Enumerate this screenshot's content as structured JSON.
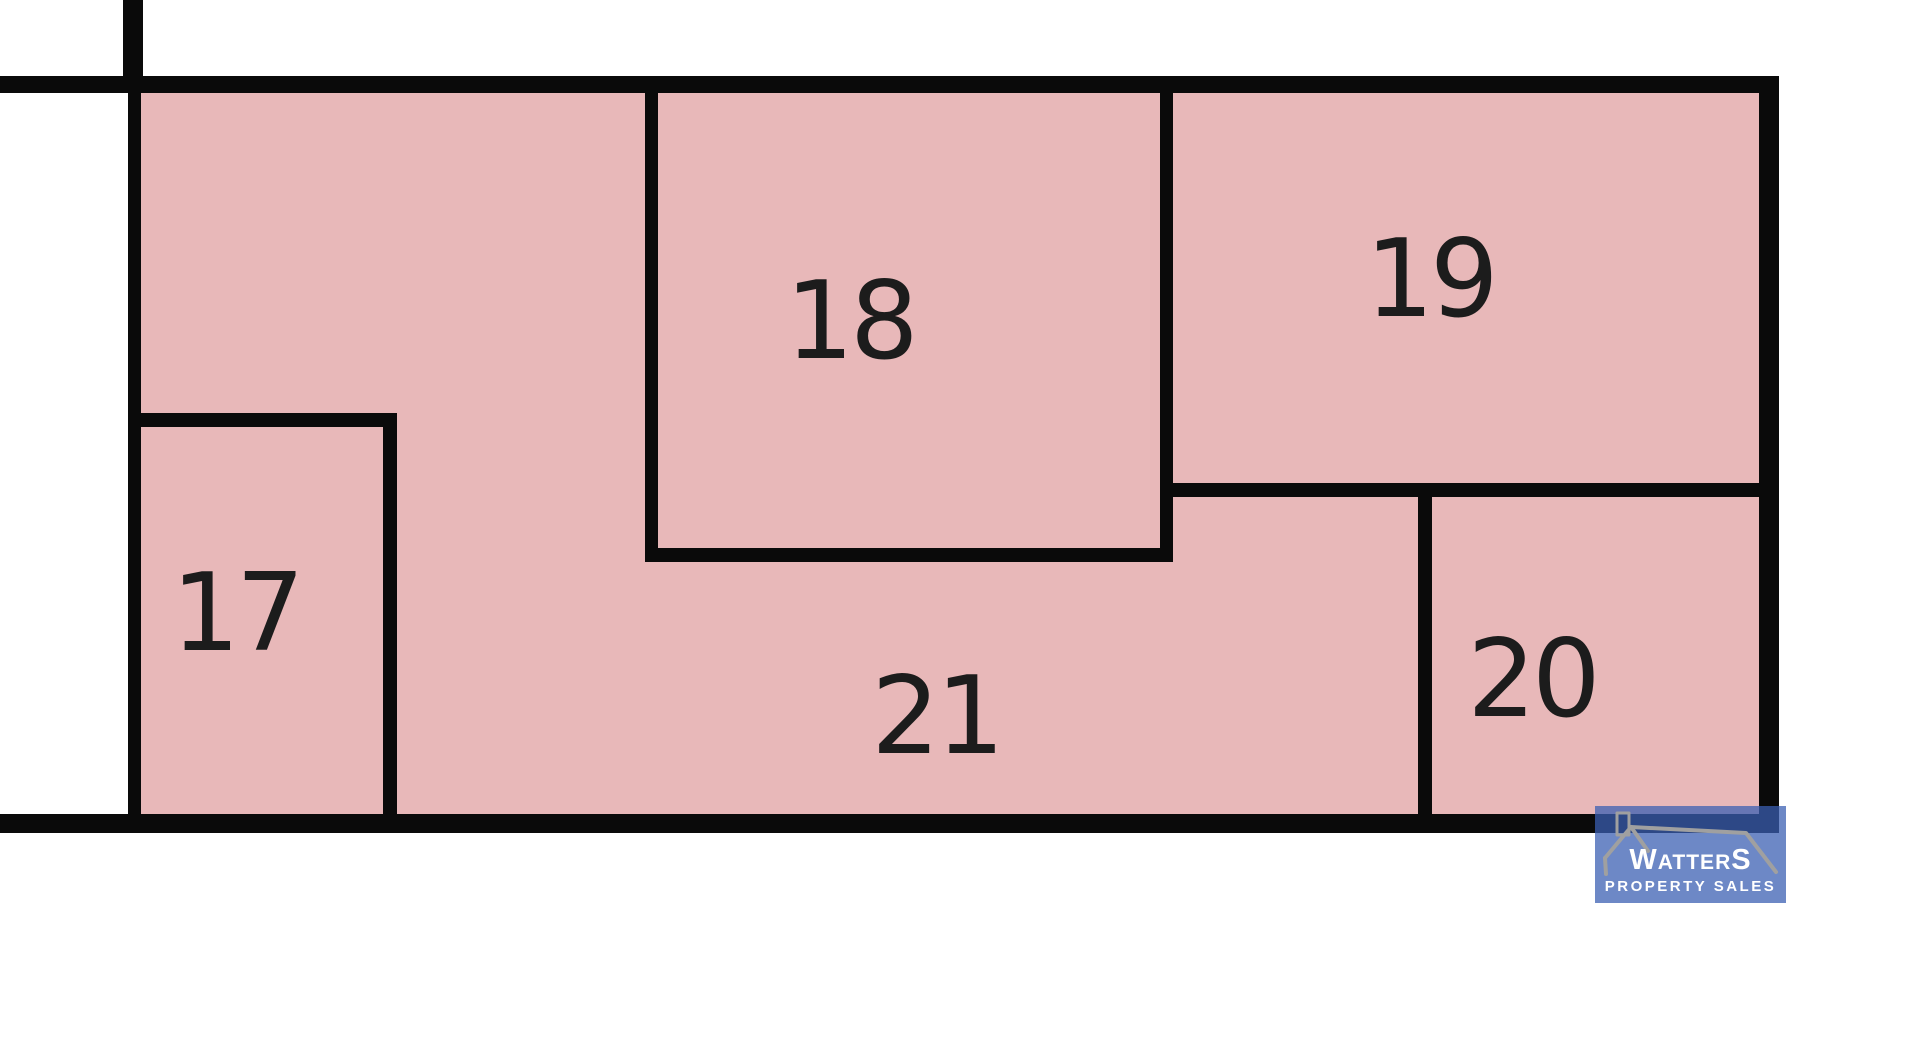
{
  "plan": {
    "fill_color": "#E8B8B9",
    "line_color": "#0A0A0A",
    "plots": [
      {
        "label": "17"
      },
      {
        "label": "18"
      },
      {
        "label": "19"
      },
      {
        "label": "20"
      },
      {
        "label": "21"
      }
    ]
  },
  "logo": {
    "brand_first": "W",
    "brand_mid": "ATTER",
    "brand_last": "S",
    "tagline": "PROPERTY SALES",
    "bg_color": "#3A5EB2",
    "roof_color": "#A0A0A0",
    "text_color": "#FFFFFF"
  }
}
